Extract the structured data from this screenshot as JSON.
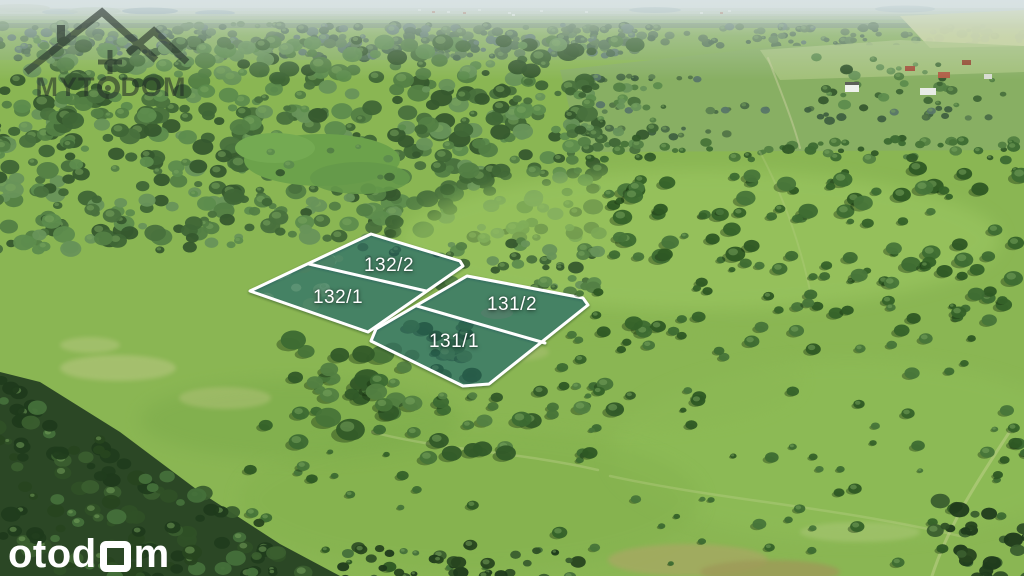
{
  "watermarks": {
    "brand": {
      "name": "MYTODOM",
      "part1": "MYT",
      "part2": "DOM"
    },
    "portal": {
      "name": "otodom",
      "prefix": "otod",
      "suffix": "m"
    }
  },
  "annotation_overlay": {
    "stroke_color": "#ffffff",
    "stroke_width": 3,
    "fill_tint": "rgba(28,104,134,0.32)",
    "label_color": "#ffffff",
    "label_font_size": 19,
    "plots": [
      {
        "parcel_group": "132",
        "outline": [
          [
            371,
            234
          ],
          [
            460,
            261
          ],
          [
            463,
            266
          ],
          [
            368,
            332
          ],
          [
            250,
            291
          ]
        ],
        "divider": [
          [
            309,
            264
          ],
          [
            426,
            291
          ]
        ],
        "parcels": [
          {
            "label": "132/2",
            "cx": 389,
            "cy": 266
          },
          {
            "label": "132/1",
            "cx": 338,
            "cy": 298
          }
        ]
      },
      {
        "parcel_group": "131",
        "outline": [
          [
            467,
            276
          ],
          [
            583,
            298
          ],
          [
            588,
            305
          ],
          [
            489,
            384
          ],
          [
            463,
            386
          ],
          [
            371,
            341
          ],
          [
            376,
            329
          ]
        ],
        "divider": [
          [
            417,
            306
          ],
          [
            545,
            343
          ]
        ],
        "parcels": [
          {
            "label": "131/2",
            "cx": 512,
            "cy": 305
          },
          {
            "label": "131/1",
            "cx": 454,
            "cy": 342
          }
        ]
      }
    ]
  }
}
